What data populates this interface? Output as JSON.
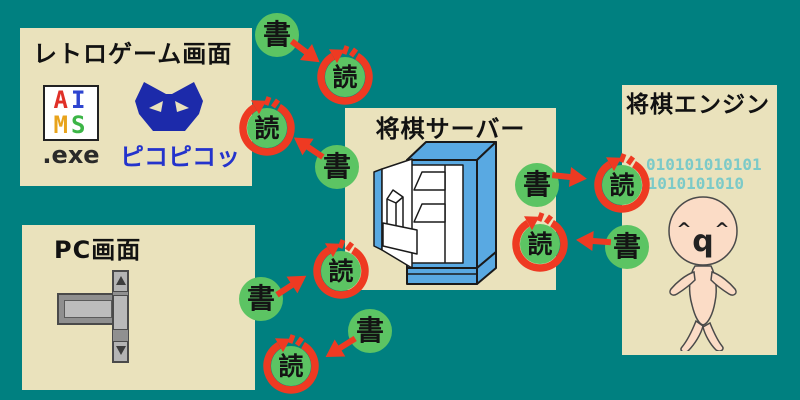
{
  "labels": {
    "write": "書",
    "read": "読"
  },
  "panels": {
    "retro_game": {
      "title": "レトロゲーム画面",
      "app_icon": {
        "letters": [
          "A",
          "I",
          "M",
          "S"
        ],
        "caption": ".exe"
      },
      "cat_caption": "ピコピコッ"
    },
    "pc": {
      "title": "PC画面"
    },
    "server": {
      "title": "将棋サーバー"
    },
    "engine": {
      "title": "将棋エンジン",
      "binary_line1": "010101010101",
      "binary_line2": "01010101010",
      "face_parts": [
        "^",
        "q",
        "^"
      ]
    }
  },
  "colors": {
    "background": "#008080",
    "panel": "#EAE2BC",
    "badge_green": "#5CC463",
    "arrow_red": "#EE3A22",
    "kanji_black": "#141414",
    "cat_blue": "#1C2AAA",
    "pico_caption_blue": "#2433CC",
    "fridge_blue": "#59A9E2",
    "binary_teal": "#7CCAC8",
    "mascot_skin": "#FBDCC6",
    "letter_a": "#E03028",
    "letter_i": "#2E45D0",
    "letter_m": "#E8A31C",
    "letter_s": "#3CB546",
    "widget_gray": "#B2B2B2",
    "widget_border": "#4A4A4A"
  }
}
